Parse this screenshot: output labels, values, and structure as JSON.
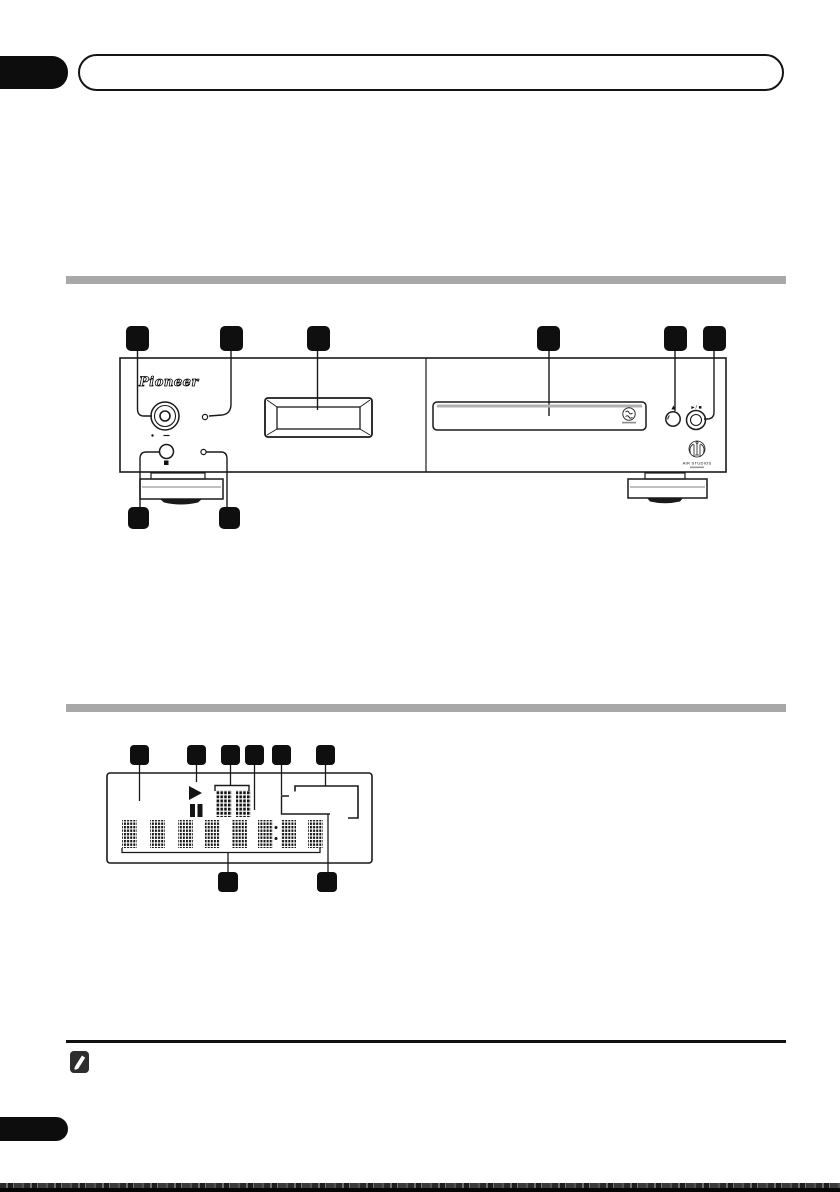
{
  "branding": {
    "pioneer_logo_text": "Pioneer",
    "air_studios_text": "AIR STUDIOS"
  },
  "front_panel_figure": {
    "eject_button_label": "▲",
    "play_stop_button_label": "►/ ■",
    "callouts_top": [
      "",
      "",
      "",
      "",
      "",
      ""
    ],
    "callouts_bottom": [
      "",
      ""
    ]
  },
  "display_figure": {
    "callouts_top": [
      "",
      "",
      "",
      "",
      "",
      ""
    ],
    "callouts_bottom": [
      "",
      ""
    ]
  },
  "icons": {
    "note": "✎",
    "eject": "▲",
    "play_stop": "►/■",
    "play_indicator": "►",
    "pause_indicator": "❚❚",
    "sacd_logo": "circle-badge",
    "air_studios_logo": "crest",
    "power_knob": "concentric-circles",
    "phones_knob": "small-circle",
    "remote_sensor": "small-square",
    "standby_led": "tiny-circle",
    "phones_level_min_mark": "·",
    "phones_level_max_mark": "−"
  },
  "colors": {
    "callout_square": "#0f0f0f",
    "section_bar": "#a8a8a8",
    "outline": "#1a1a1a",
    "tray_highlight": "#b0b0b0"
  }
}
